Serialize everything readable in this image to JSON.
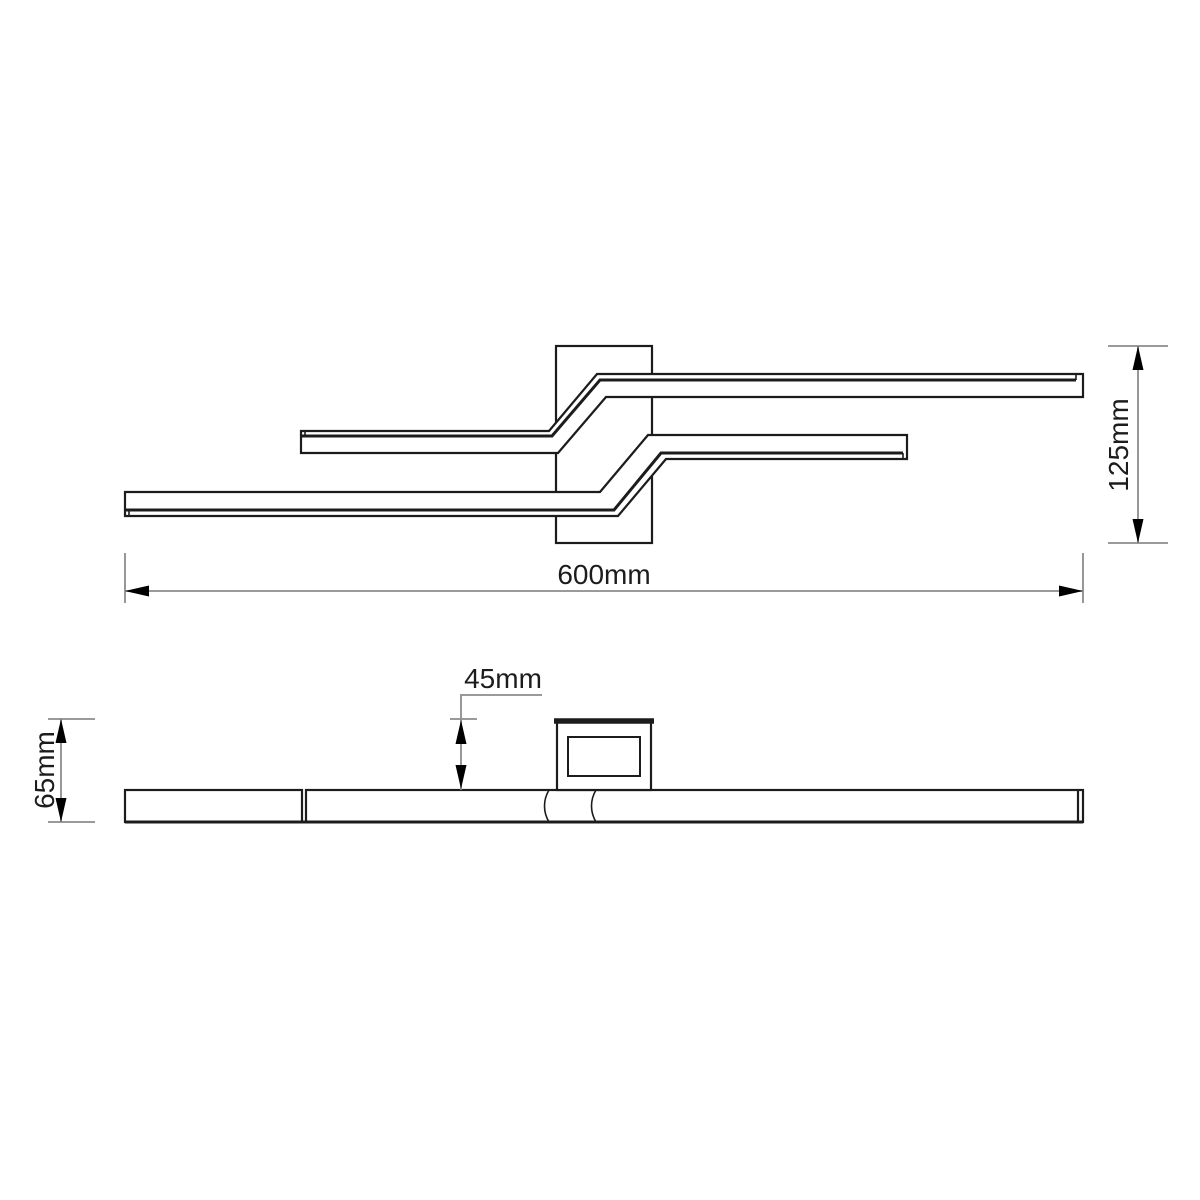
{
  "dimensions": {
    "width": {
      "label": "600mm"
    },
    "height": {
      "label": "125mm"
    },
    "offset": {
      "label": "45mm"
    },
    "depth": {
      "label": "65mm"
    }
  },
  "colors": {
    "line": "#1c1c1c",
    "dimension_line": "#8c8c8c",
    "arrow": "#000000",
    "text": "#1c1c1c",
    "background": "#ffffff"
  }
}
